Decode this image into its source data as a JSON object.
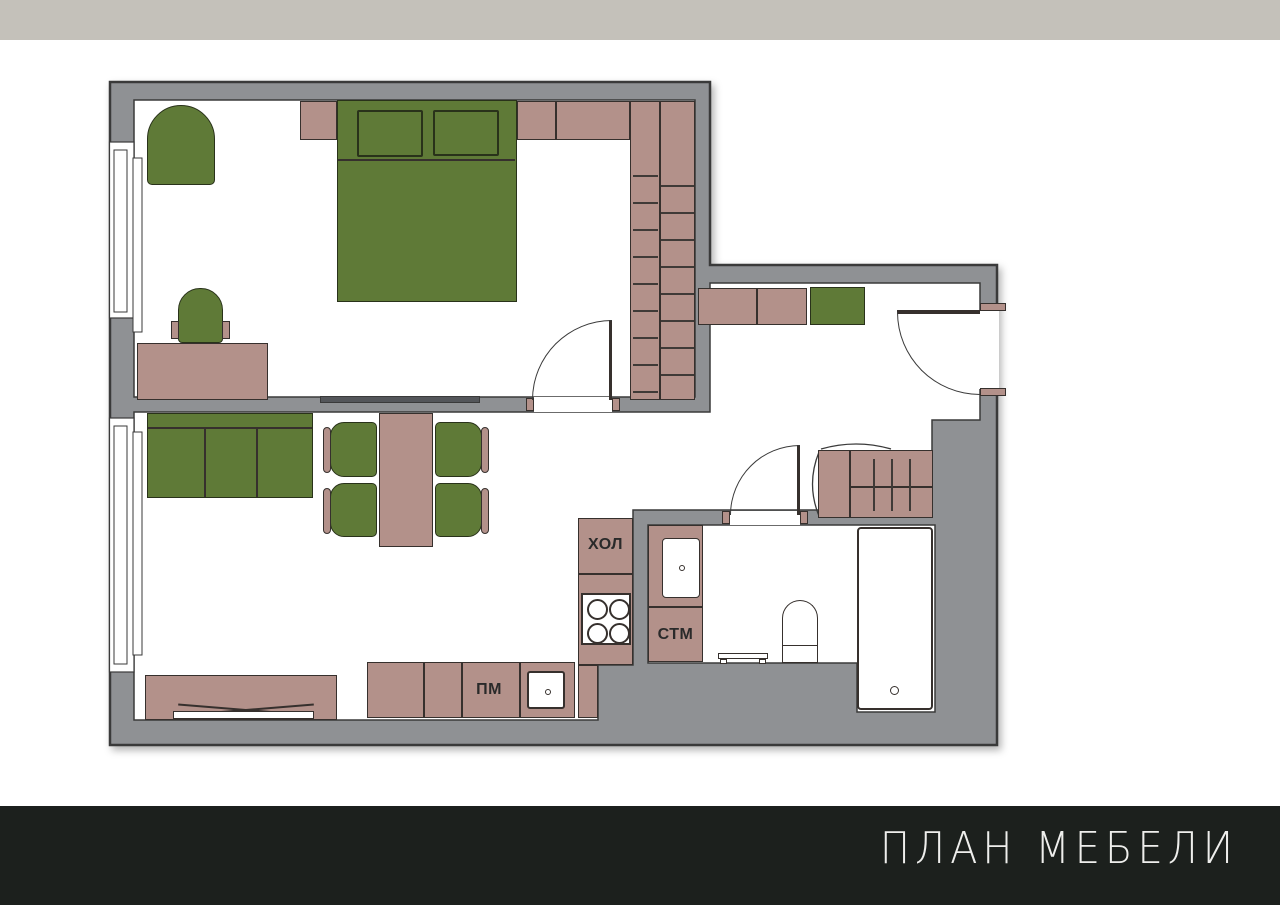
{
  "page": {
    "top_bar_color": "#c4c1ba",
    "background_color": "#ffffff"
  },
  "footer": {
    "title": "ПЛАН МЕБЕЛИ",
    "bar_color": "#1c201d",
    "text_color": "#eeeeec"
  },
  "plan": {
    "labels": {
      "fridge": "ХОЛ",
      "washing_machine": "СТМ",
      "dishwasher": "ПМ"
    },
    "colors": {
      "wall_gray": "#8f9194",
      "furniture_green": "#5f7a37",
      "furniture_mauve": "#b3918a",
      "outline_dark": "#36302d",
      "floor_white": "#ffffff"
    }
  }
}
